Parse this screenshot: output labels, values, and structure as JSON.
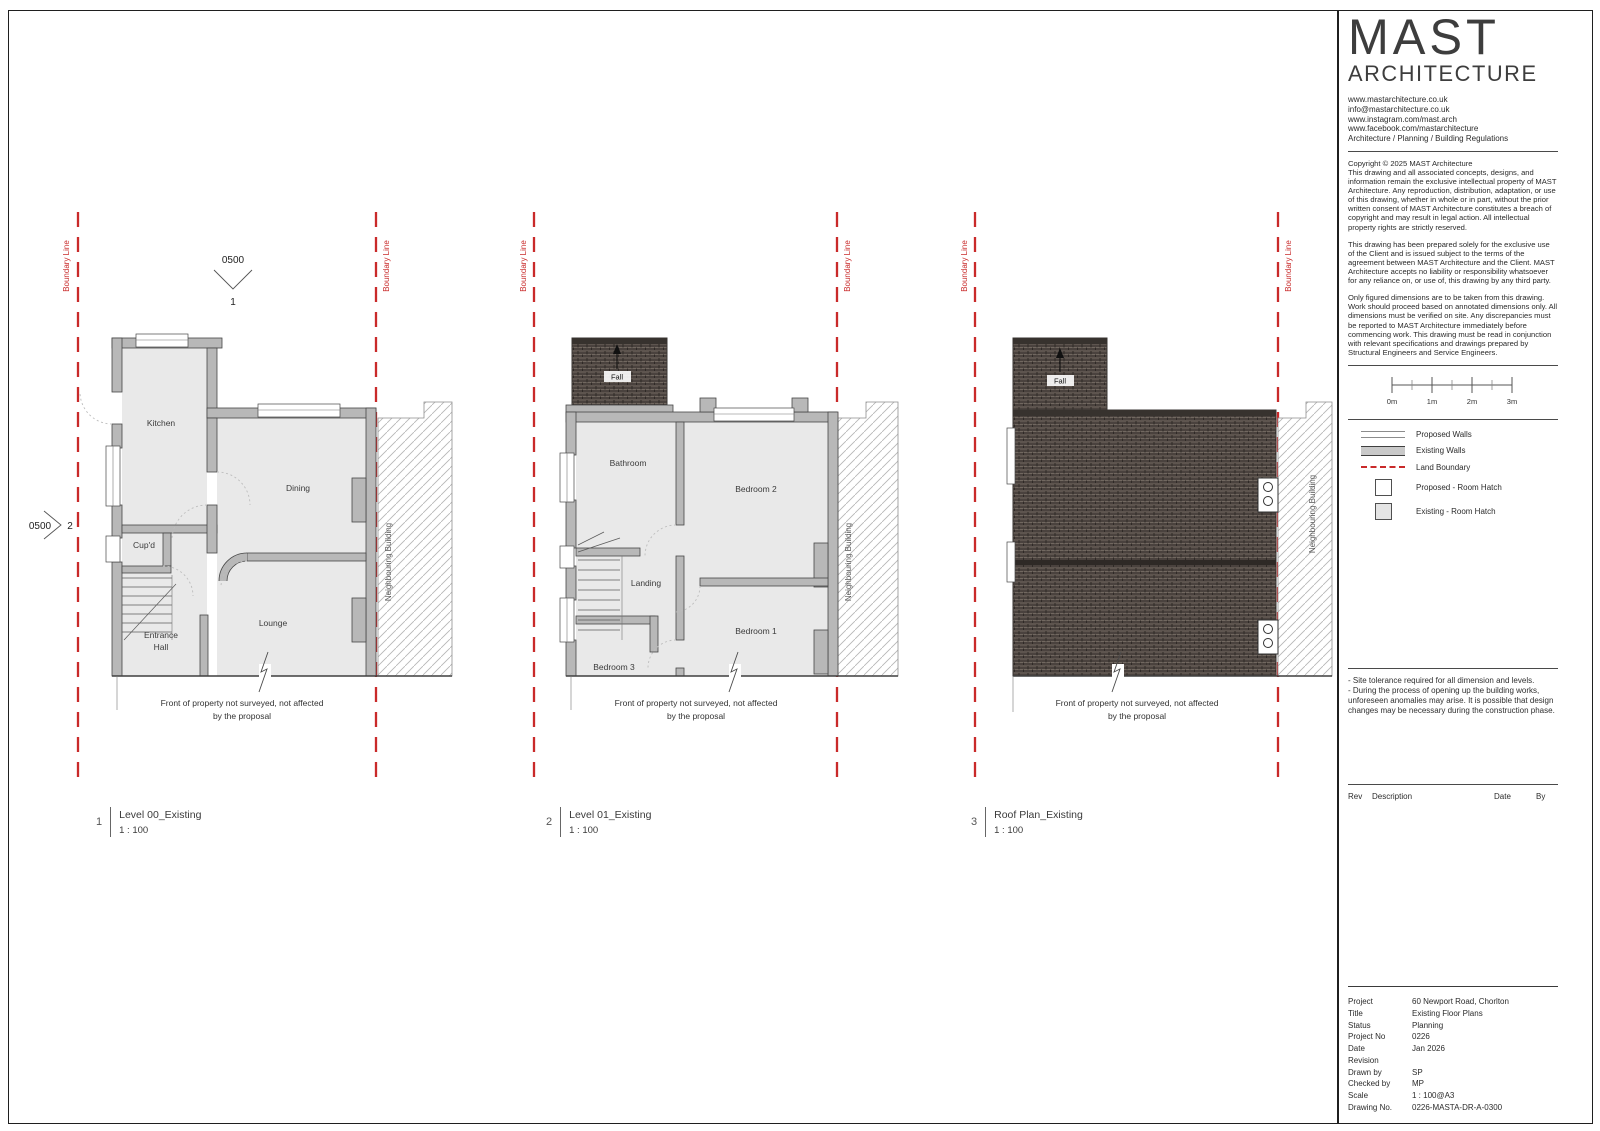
{
  "titleblock": {
    "brand": {
      "logo_top": "MAST",
      "logo_bottom": "ARCHITECTURE",
      "links": [
        "www.mastarchitecture.co.uk",
        "info@mastarchitecture.co.uk",
        "www.instagram.com/mast.arch",
        "www.facebook.com/mastarchitecture",
        "Architecture / Planning / Building Regulations"
      ]
    },
    "copyright": {
      "p1": "Copyright © 2025 MAST Architecture\nThis drawing and all associated concepts, designs, and information remain the exclusive intellectual property of MAST Architecture. Any reproduction, distribution, adaptation, or use of this drawing, whether in whole or in part, without the prior written consent of MAST Architecture constitutes a breach of copyright and may result in legal action. All intellectual property rights are strictly reserved.",
      "p2": "This drawing has been prepared solely for the exclusive use of the Client and is issued subject to the terms of the agreement between MAST Architecture and the Client. MAST Architecture accepts no liability or responsibility whatsoever for any reliance on, or use of, this drawing by any third party.",
      "p3": "Only figured dimensions are to be taken from this drawing. Work should proceed based on annotated dimensions only. All dimensions must be verified on site. Any discrepancies must be reported to MAST Architecture immediately before commencing work. This drawing must be read in conjunction with relevant specifications and drawings prepared by Structural Engineers and Service Engineers."
    },
    "scalebar": {
      "labels": [
        "0m",
        "1m",
        "2m",
        "3m"
      ]
    },
    "legend": {
      "items": [
        "Proposed Walls",
        "Existing Walls",
        "Land Boundary",
        "Proposed - Room Hatch",
        "Existing - Room Hatch"
      ]
    },
    "notes": {
      "line1": "- Site tolerance required for all dimension and levels.",
      "line2": "- During the process of opening up the building works, unforeseen anomalies may arise. It is possible that design changes may be necessary during the construction phase."
    },
    "rev_table": {
      "rev": "Rev",
      "description": "Description",
      "date": "Date",
      "by": "By"
    },
    "project_table": {
      "rows": [
        {
          "label": "Project",
          "value": "60 Newport Road, Chorlton"
        },
        {
          "label": "Title",
          "value": "Existing Floor Plans"
        },
        {
          "label": "Status",
          "value": "Planning"
        },
        {
          "label": "Project No",
          "value": "0226"
        },
        {
          "label": "Date",
          "value": "Jan 2026"
        },
        {
          "label": "Revision",
          "value": ""
        },
        {
          "label": "Drawn by",
          "value": "SP"
        },
        {
          "label": "Checked by",
          "value": "MP"
        },
        {
          "label": "Scale",
          "value": "1 : 100@A3"
        },
        {
          "label": "Drawing No.",
          "value": "0226-MASTA-DR-A-0300"
        }
      ]
    },
    "colors": {
      "boundary_red": "#c92a2a",
      "wall_fill": "#b8b8b8",
      "room_fill": "#e9e9e9",
      "roof_dark": "#4a423e"
    }
  },
  "plans": [
    {
      "number": "1",
      "title": "Level 00_Existing",
      "scale": "1 : 100",
      "boundary_label": "Boundary Line",
      "neighbour_label": "Neighbouring Building",
      "front_note_line1": "Front of property not surveyed, not affected",
      "front_note_line2": "by the proposal",
      "rooms": {
        "kitchen": "Kitchen",
        "dining": "Dining",
        "cupd": "Cup'd",
        "entrance1": "Entrance",
        "entrance2": "Hall",
        "lounge": "Lounge"
      },
      "markers": {
        "top_ref": "0500",
        "top_num": "1",
        "left_ref": "0500",
        "left_num": "2"
      }
    },
    {
      "number": "2",
      "title": "Level 01_Existing",
      "scale": "1 : 100",
      "boundary_label": "Boundary Line",
      "neighbour_label": "Neighbouring Building",
      "front_note_line1": "Front of property not surveyed, not affected",
      "front_note_line2": "by the proposal",
      "rooms": {
        "bathroom": "Bathroom",
        "bedroom2": "Bedroom 2",
        "landing": "Landing",
        "bedroom3": "Bedroom 3",
        "bedroom1": "Bedroom 1"
      },
      "fall_label": "Fall"
    },
    {
      "number": "3",
      "title": "Roof Plan_Existing",
      "scale": "1 : 100",
      "boundary_label": "Boundary Line",
      "neighbour_label": "Neighbouring Building",
      "front_note_line1": "Front of property not surveyed, not affected",
      "front_note_line2": "by the proposal",
      "fall_label": "Fall"
    }
  ]
}
